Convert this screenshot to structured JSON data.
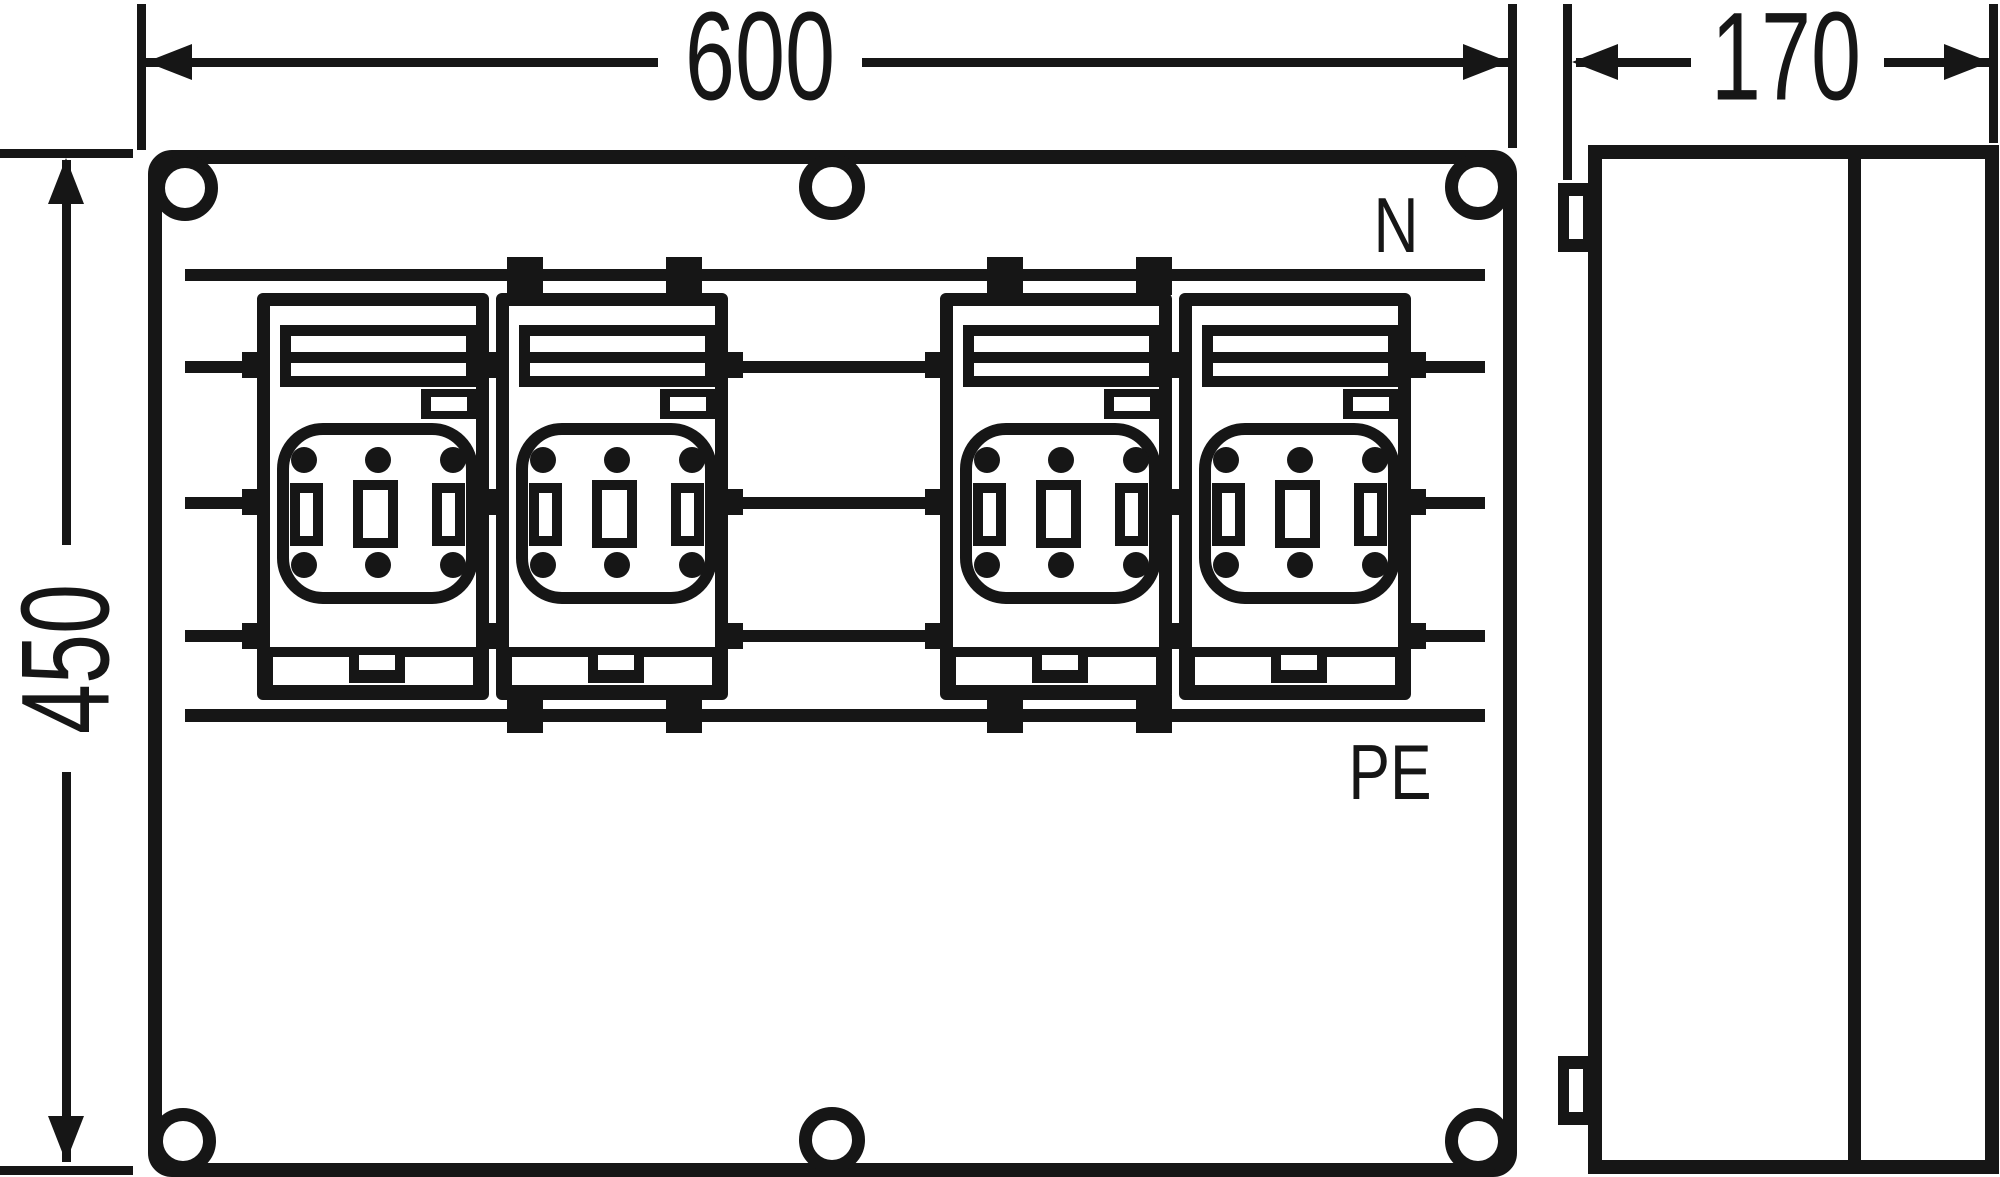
{
  "drawing": {
    "type": "enclosure-dimension-drawing",
    "views": {
      "front": "front-view",
      "side": "side-view"
    },
    "fuse_unit_count": 4
  },
  "dimension_labels": {
    "width": "600",
    "height": "450",
    "depth": "170"
  },
  "busbar_labels": {
    "neutral": "N",
    "protective_earth": "PE"
  },
  "colors": {
    "line": "#161616",
    "background": "#ffffff"
  }
}
